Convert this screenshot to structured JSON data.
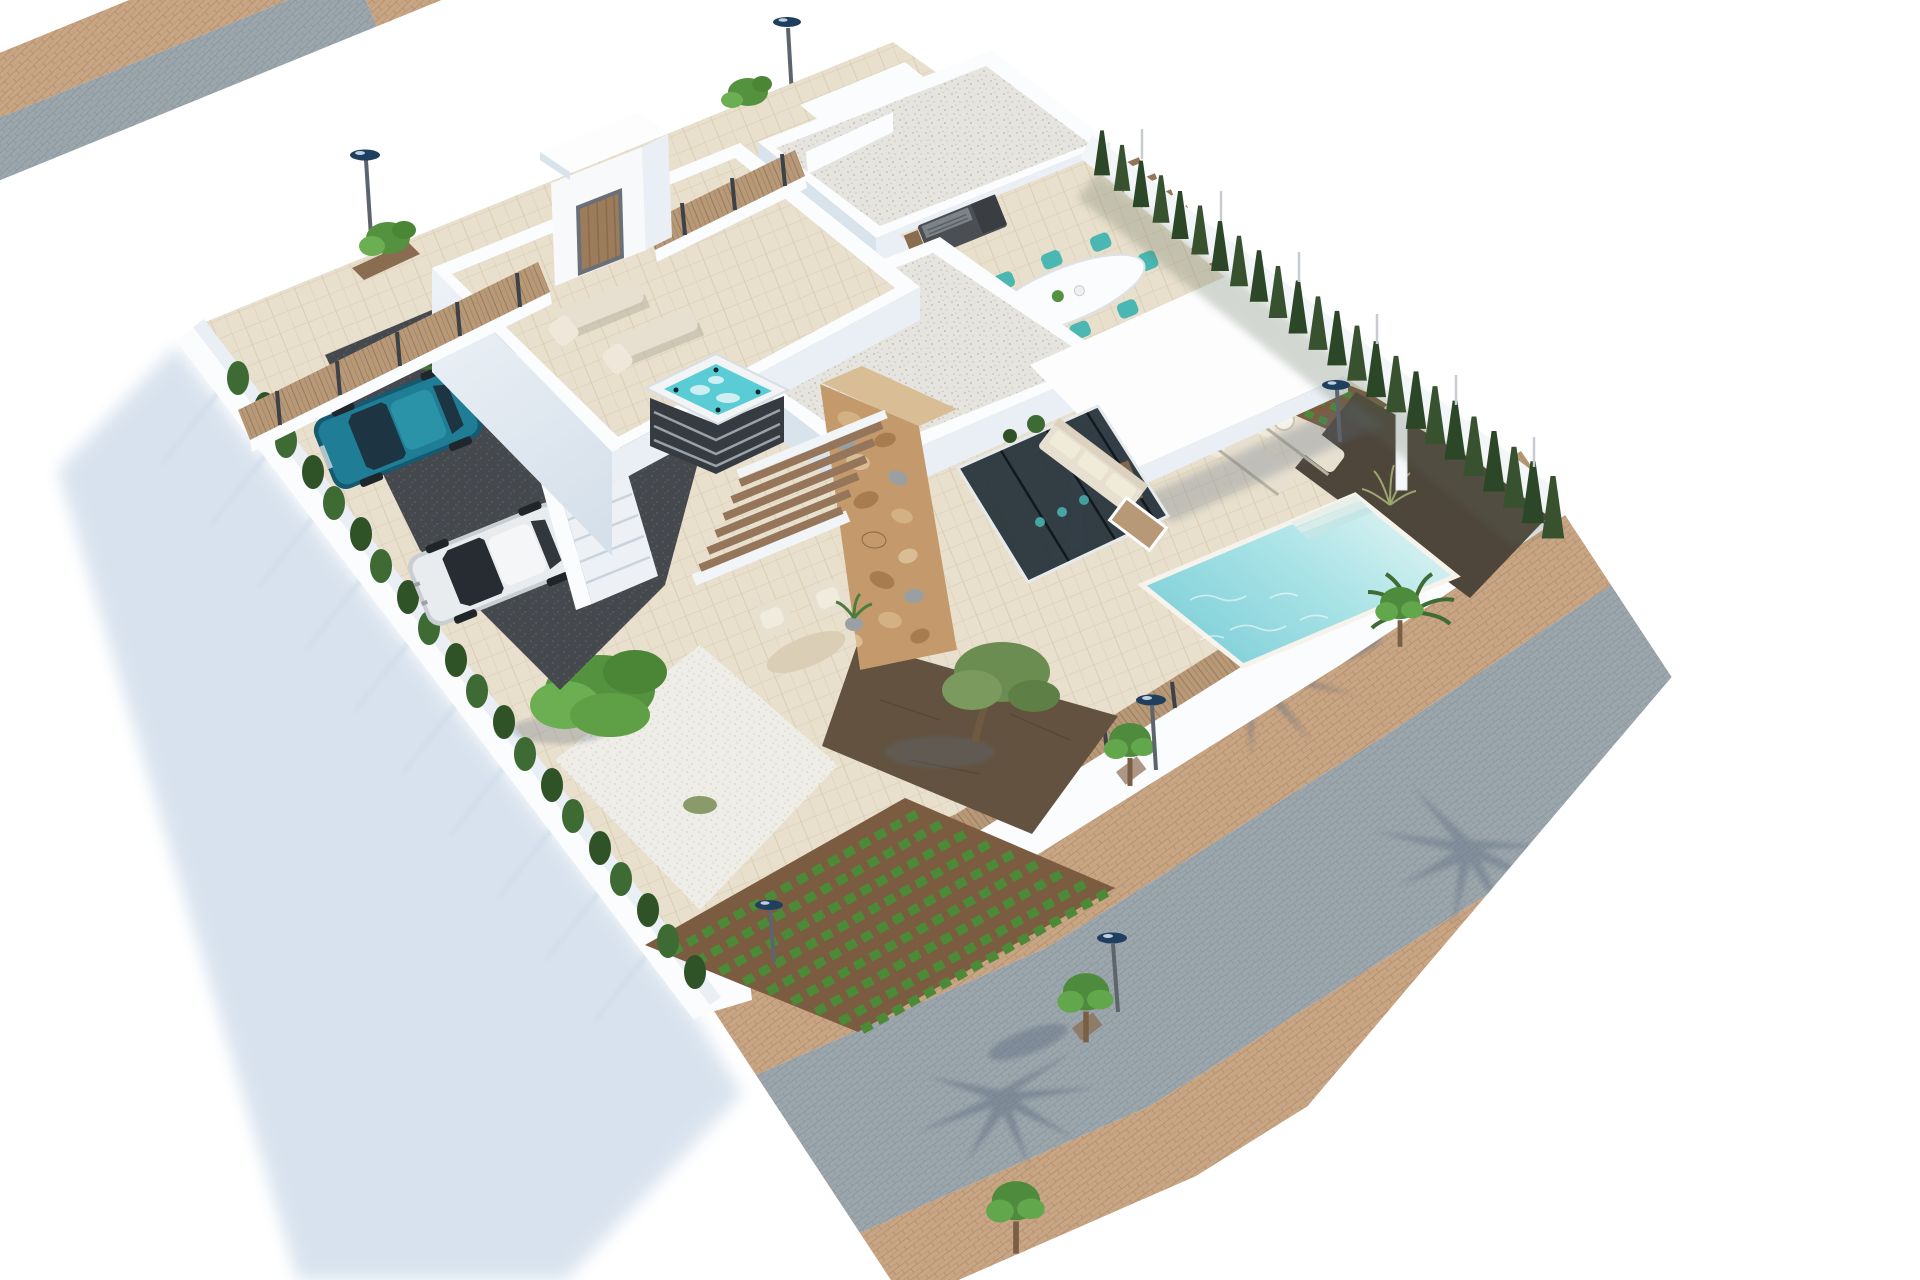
{
  "image": {
    "type": "3d-architectural-render",
    "subject": "Aerial view of a modern two-storey white villa on a walled corner plot with pool, roof terrace and gardens",
    "view": "high-angle aerial, plot rotated diagonally on a plain white background",
    "visible_text": "none"
  },
  "scene": {
    "plot": {
      "boundaries": [
        "brick-and-cobble pavement along upper-left side",
        "cypress hedge with fence along upper-right side",
        "cobbled street with brick sidewalks along lower-right side",
        "tall white wall casting long shadow along lower-left side"
      ],
      "lampposts": 6,
      "street_trees": 4,
      "palm_frond_shadows": 3
    },
    "villa": {
      "style": "modern white flat-roof volumes with gravel roofs",
      "feature_wall": "rustic tan stone-clad chimney wall",
      "glazing": "dark glass sliding walls facing the pool terrace",
      "cantilever_roof": "large bright white slab over outdoor lounge with thin columns",
      "entrance_portal": "white portal frame with wooden door on upper-left fence line",
      "exterior_staircase": "white stair from driveway up to roof terrace",
      "pergolas": "wooden louvre slats over stair void and bench slats on upper-right terraces"
    },
    "roof_terrace": {
      "floor": "beige tiles",
      "loungers": 2,
      "hot_tub": 1
    },
    "dining_terrace": {
      "table": "white oval dining table",
      "chairs": 8,
      "chair_color": "turquoise",
      "bbq_grill": 1
    },
    "pool_area": {
      "pool": "turquoise rectangular pool",
      "steps": 3,
      "loungers": 2,
      "side_table": 1,
      "palm_plant": 1,
      "mulch_bed_with_grass": 1
    },
    "garden": {
      "white_gravel_patch": 1,
      "large_bush": 1,
      "grass_tufts": 2,
      "vegetable_rows_main_field": 9,
      "vegetable_rows_side_strip": 3,
      "olive_tree_on_dark_soil": 1,
      "armchairs": 2,
      "round_rug": 1,
      "potted_plant": 1
    },
    "outdoor_lounge": {
      "sofa": 1,
      "coffee_table": 1,
      "planters": 2
    },
    "driveway": {
      "surface": "dark gravel",
      "cars": [
        {
          "color": "teal-blue"
        },
        {
          "color": "white"
        }
      ],
      "hedge_bushes": 20,
      "leafy_plants": 2
    },
    "hedges": {
      "cypress_trees_right_side": 24
    }
  },
  "palette": {
    "bg": "#ffffff",
    "wallWhite": "#fafcfd",
    "slabWhite": "#fdfdfe",
    "wallShade": "#d9e3ec",
    "wallShade2": "#e9eff5",
    "shadow": "#cfdcea",
    "shadowDark": "#5c6d80",
    "brickBase": "#c8a584",
    "brickLine": "#b28d68",
    "cobbleBase": "#9ca6ad",
    "cobbleLine": "#8a949b",
    "woodBase": "#b79877",
    "woodLine": "#96765a",
    "woodDark": "#8a6c50",
    "postDark": "#3c4248",
    "roofGravel": "#e6e4df",
    "roofGravelDot": "#c9c5bd",
    "whiteGravel": "#efede7",
    "whiteGravelDot": "#d7d3c9",
    "terrace": "#e8dfcc",
    "terraceLine": "#d8cdb4",
    "asphalt": "#45494e",
    "asphaltDot": "#5a5f65",
    "pool1": "#d6f1f1",
    "pool2": "#7fcfd8",
    "hotTub": "#59ccd6",
    "tubBase": "#363b41",
    "tubSlat": "#9aa2a9",
    "cypress1": "#2c4727",
    "cypress2": "#385230",
    "hedge": "#3e6b33",
    "hedgeDark": "#2f5227",
    "bush1": "#55923f",
    "bush2": "#6cae52",
    "crop": "#4c8a38",
    "soil": "#7b5c41",
    "dirt": "#63523f",
    "mulch": "#4e453b",
    "stoneTop": "#d9bd94",
    "stone1": "#c49a6c",
    "stone2": "#a87c4f",
    "stone3": "#d3b185",
    "stone4": "#9aa0a2",
    "glass": "#28343c",
    "teal": "#4ab7b3",
    "cream": "#e7dfd0",
    "creamDark": "#cfc5b2",
    "carTeal": "#1f7e95",
    "carTealDark": "#155a70",
    "carWhite": "#e9ecee",
    "lampTop": "#1f3f5e",
    "pole": "#5d646b",
    "olive": "#6b8d51",
    "treeGreen": "#4e8b3c",
    "treeGreen2": "#63a74c"
  }
}
